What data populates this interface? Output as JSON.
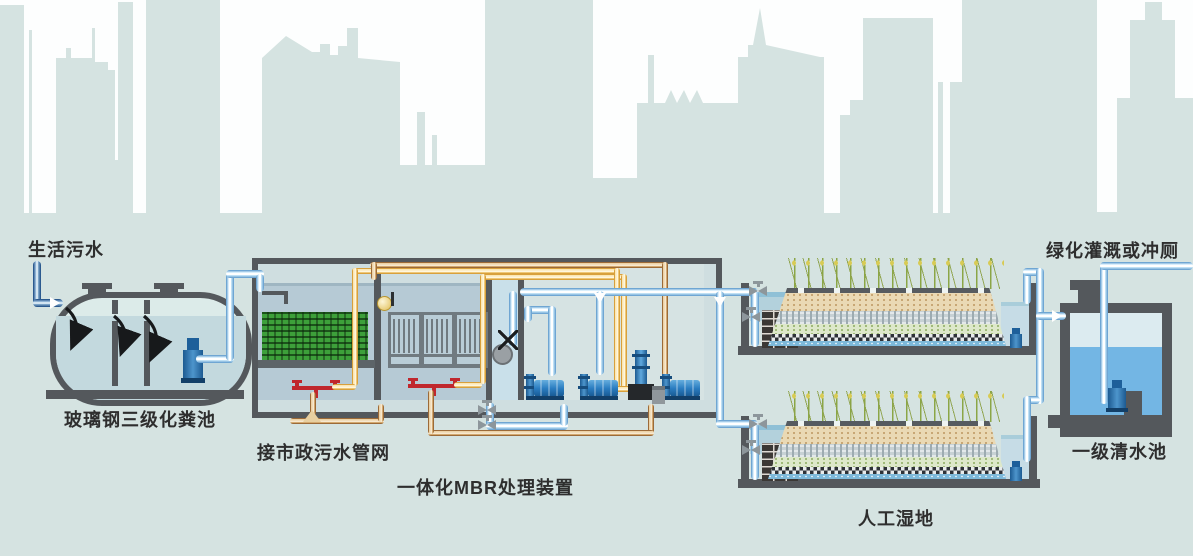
{
  "labels": {
    "inflow": "生活污水",
    "septic": "玻璃钢三级化粪池",
    "municipal": "接市政污水管网",
    "mbr": "一体化MBR处理装置",
    "wetland": "人工湿地",
    "clearwater": "一级清水池",
    "reuse": "绿化灌溉或冲厕"
  },
  "colors": {
    "skyline": "#d5e3e1",
    "structure_gray": "#54585c",
    "mbr_water": "#b6cad5",
    "clear_water": "#73b6e4",
    "pipe_blue": "#bfe0f4",
    "pipe_dark_blue": "#2c5a8f",
    "air_pipe_yellow": "#eec878",
    "sludge_pipe_brown": "#d3a96f",
    "aerator_red": "#c0272d",
    "pump_blue": "#2a7cc0",
    "bio_media_green": "#3da03a"
  }
}
